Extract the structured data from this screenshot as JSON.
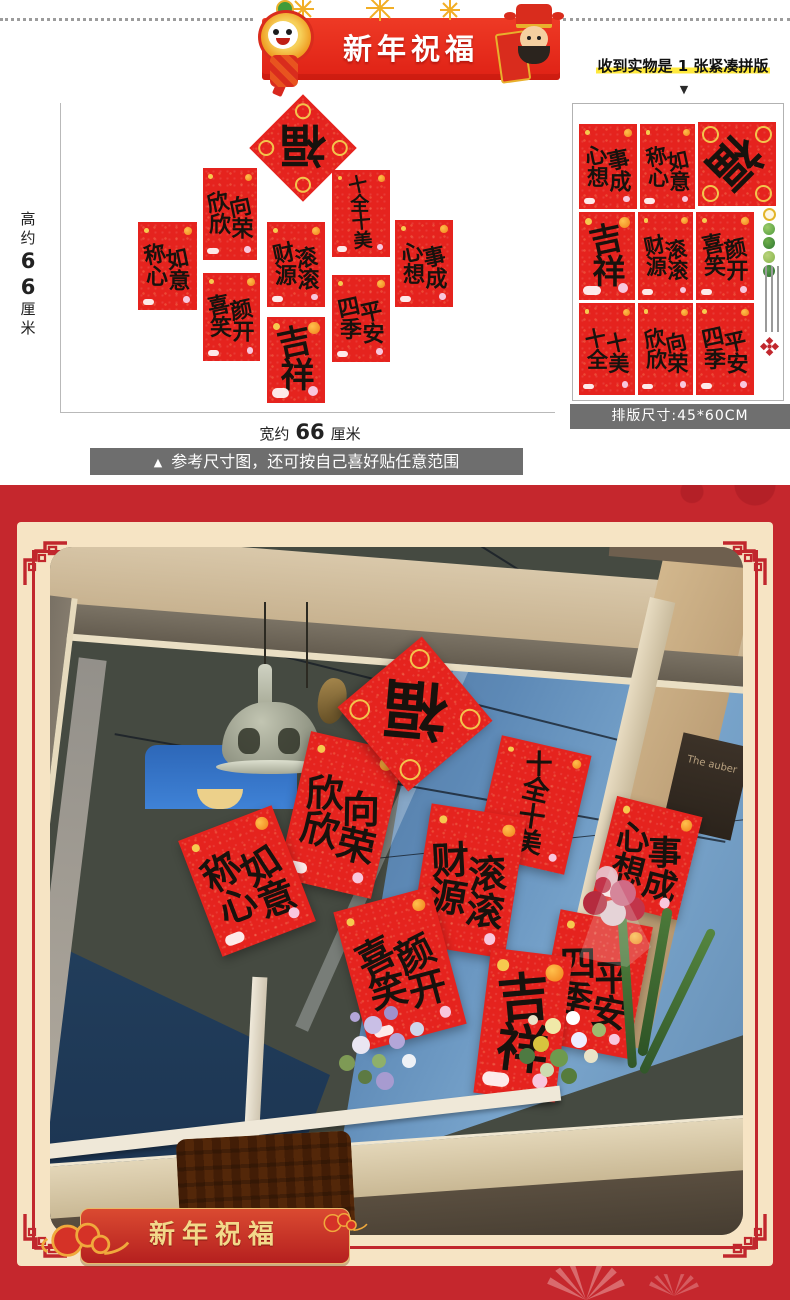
{
  "top_banner": {
    "title": "新年祝福"
  },
  "received_note": {
    "text": "收到实物是 1 张紧凑拼版",
    "arrow": "▼"
  },
  "product_sheet": {
    "caption": "排版尺寸:45*60CM"
  },
  "size_diagram": {
    "height_prefix": "高约",
    "height_value": "66",
    "height_unit": "厘米",
    "width_prefix": "宽约",
    "width_value": "66",
    "width_unit": "厘米"
  },
  "caption_banner": {
    "icon": "▲",
    "text": "参考尺寸图，还可按自己喜好贴任意范围"
  },
  "phrases": {
    "fu": "福",
    "xinxin": "欣欣向荣",
    "shiquan": "十全十美",
    "chenxin": "称心如意",
    "caiyuan": "财源滚滚",
    "xinxiang": "心想事成",
    "xixiao": "喜笑颜开",
    "siji": "四季平安",
    "jixiang": "吉祥"
  },
  "photo": {
    "plaque_text": "The auber"
  },
  "footer_banner": {
    "title": "新年祝福"
  },
  "colors": {
    "banner_red": "#e8291f",
    "tile_red": "#e5231e",
    "section_red": "#c5272d",
    "cream": "#f6e4c4",
    "frame_red": "#c1272d",
    "caption_gray": "#6e6e6e",
    "highlight_yellow": "#ffe93c",
    "gold": "#f5c648",
    "footer_gold": "#f2d98a"
  }
}
